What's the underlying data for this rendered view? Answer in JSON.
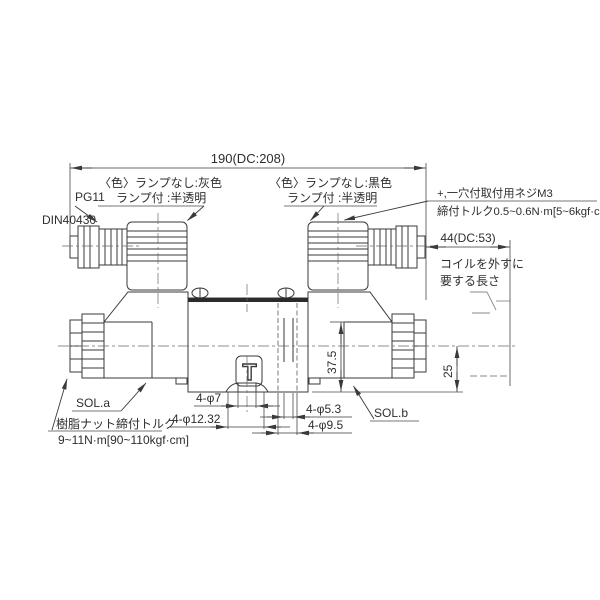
{
  "drawing": {
    "dim_width": "190(DC:208)",
    "dim_coil_removal": "44(DC:53)",
    "dim_height_top": "37.5",
    "dim_height_center": "25",
    "dim_phi7": "4-φ7",
    "dim_phi1232": "4-φ12.32",
    "dim_phi53": "4-φ5.3",
    "dim_phi95": "4-φ9.5",
    "gland_label_1": "PG11",
    "gland_label_2": "DIN40430",
    "color_a_line1": "〈色〉ランプなし:灰色",
    "color_a_line2": "ランプ付 :半透明",
    "color_b_line1": "〈色〉ランプなし:黒色",
    "color_b_line2": "ランプ付 :半透明",
    "m3_line1": "+,一穴付取付用ネジM3",
    "m3_line2": "締付トルク0.5~0.6N·m[5~6kgf·cm]",
    "coil_note_line1": "コイルを外すに",
    "coil_note_line2": "要する長さ",
    "sol_a": "SOL.a",
    "sol_b": "SOL.b",
    "nut_torque_line1": "樹脂ナット締付トルク",
    "nut_torque_line2": "9~11N·m[90~110kgf·cm]",
    "t_mark": "T",
    "line_color": "#3a3a3a",
    "background": "#ffffff"
  }
}
